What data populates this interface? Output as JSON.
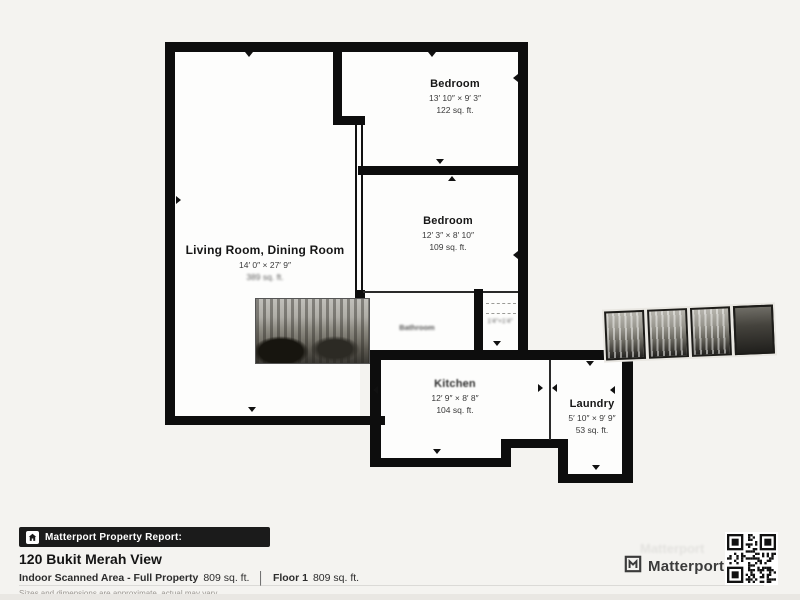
{
  "colors": {
    "background": "#f4f3f0",
    "floor": "#fdfdfc",
    "wall": "#0d0d0d",
    "badge_bg": "#1b1b1b",
    "badge_text": "#ffffff",
    "disclaimer_text": "#9a9691"
  },
  "floorplan": {
    "rooms": [
      {
        "name": "Bedroom",
        "dims": "13′ 10″ × 9′ 3″",
        "area": "122 sq. ft."
      },
      {
        "name": "Bedroom",
        "dims": "12′ 3″ × 8′ 10″",
        "area": "109 sq. ft."
      },
      {
        "name": "Living Room, Dining Room",
        "dims": "14′ 0″ × 27′ 9″",
        "area": "389 sq. ft."
      },
      {
        "name": "Kitchen",
        "dims": "12′ 9″ × 8′ 8″",
        "area": "104 sq. ft."
      },
      {
        "name": "Laundry",
        "dims": "5′ 10″ × 9′ 9″",
        "area": "53 sq. ft."
      }
    ],
    "artifacts": {
      "bathroom_label": "Bathroom",
      "closet_smudge": "1′4″×1′4″"
    }
  },
  "footer": {
    "badge_label": "Matterport Property Report:",
    "address": "120 Bukit Merah View",
    "area_label_full": "Indoor Scanned Area - Full Property",
    "area_value_full": "809 sq. ft.",
    "separator": "│",
    "floor_label": "Floor 1",
    "floor_value": "809 sq. ft.",
    "disclaimer": "Sizes and dimensions are approximate, actual may vary",
    "brand": "Matterport"
  }
}
